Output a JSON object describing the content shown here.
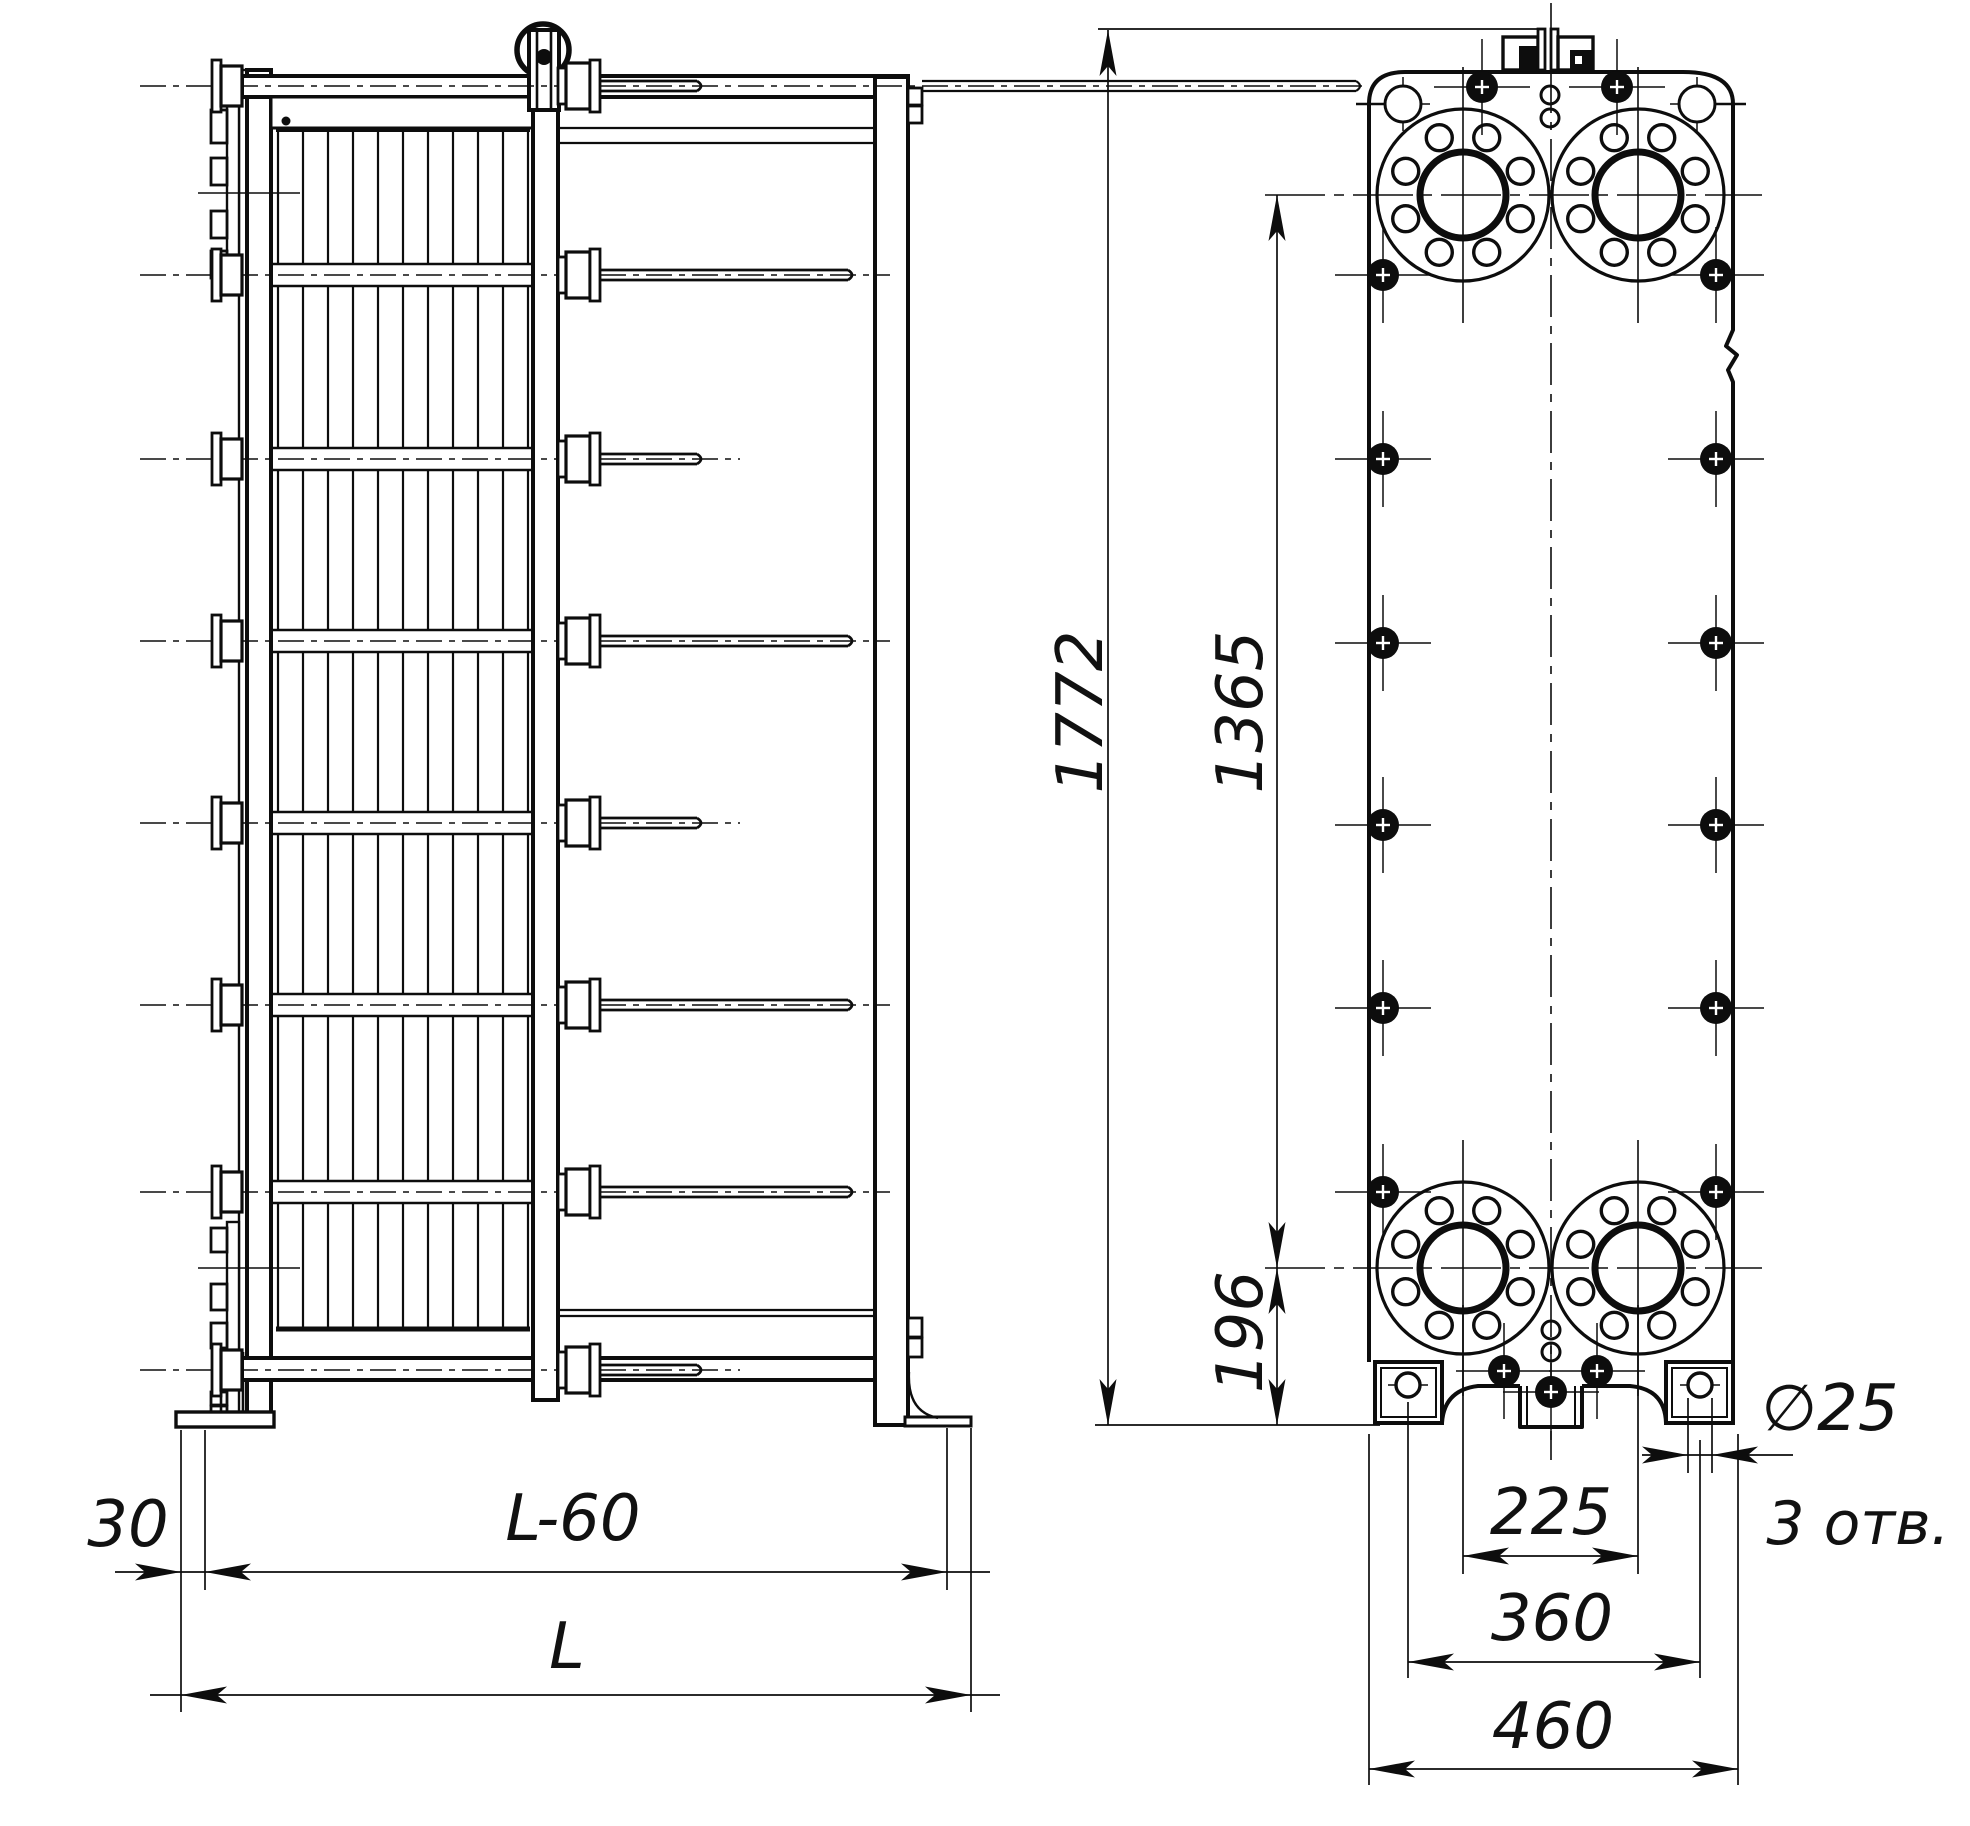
{
  "drawing": {
    "side_view": {
      "dim_offset": "30",
      "dim_length_minus_60": "L-60",
      "dim_length": "L"
    },
    "front_view": {
      "dim_total_height": "1772",
      "dim_port_height": "1365",
      "dim_foot_height": "196",
      "dim_port_spacing": "225",
      "dim_foot_hole_spacing": "360",
      "dim_base_width": "460",
      "dim_hole_diameter": "∅25",
      "dim_holes_note": "3 отв."
    }
  }
}
